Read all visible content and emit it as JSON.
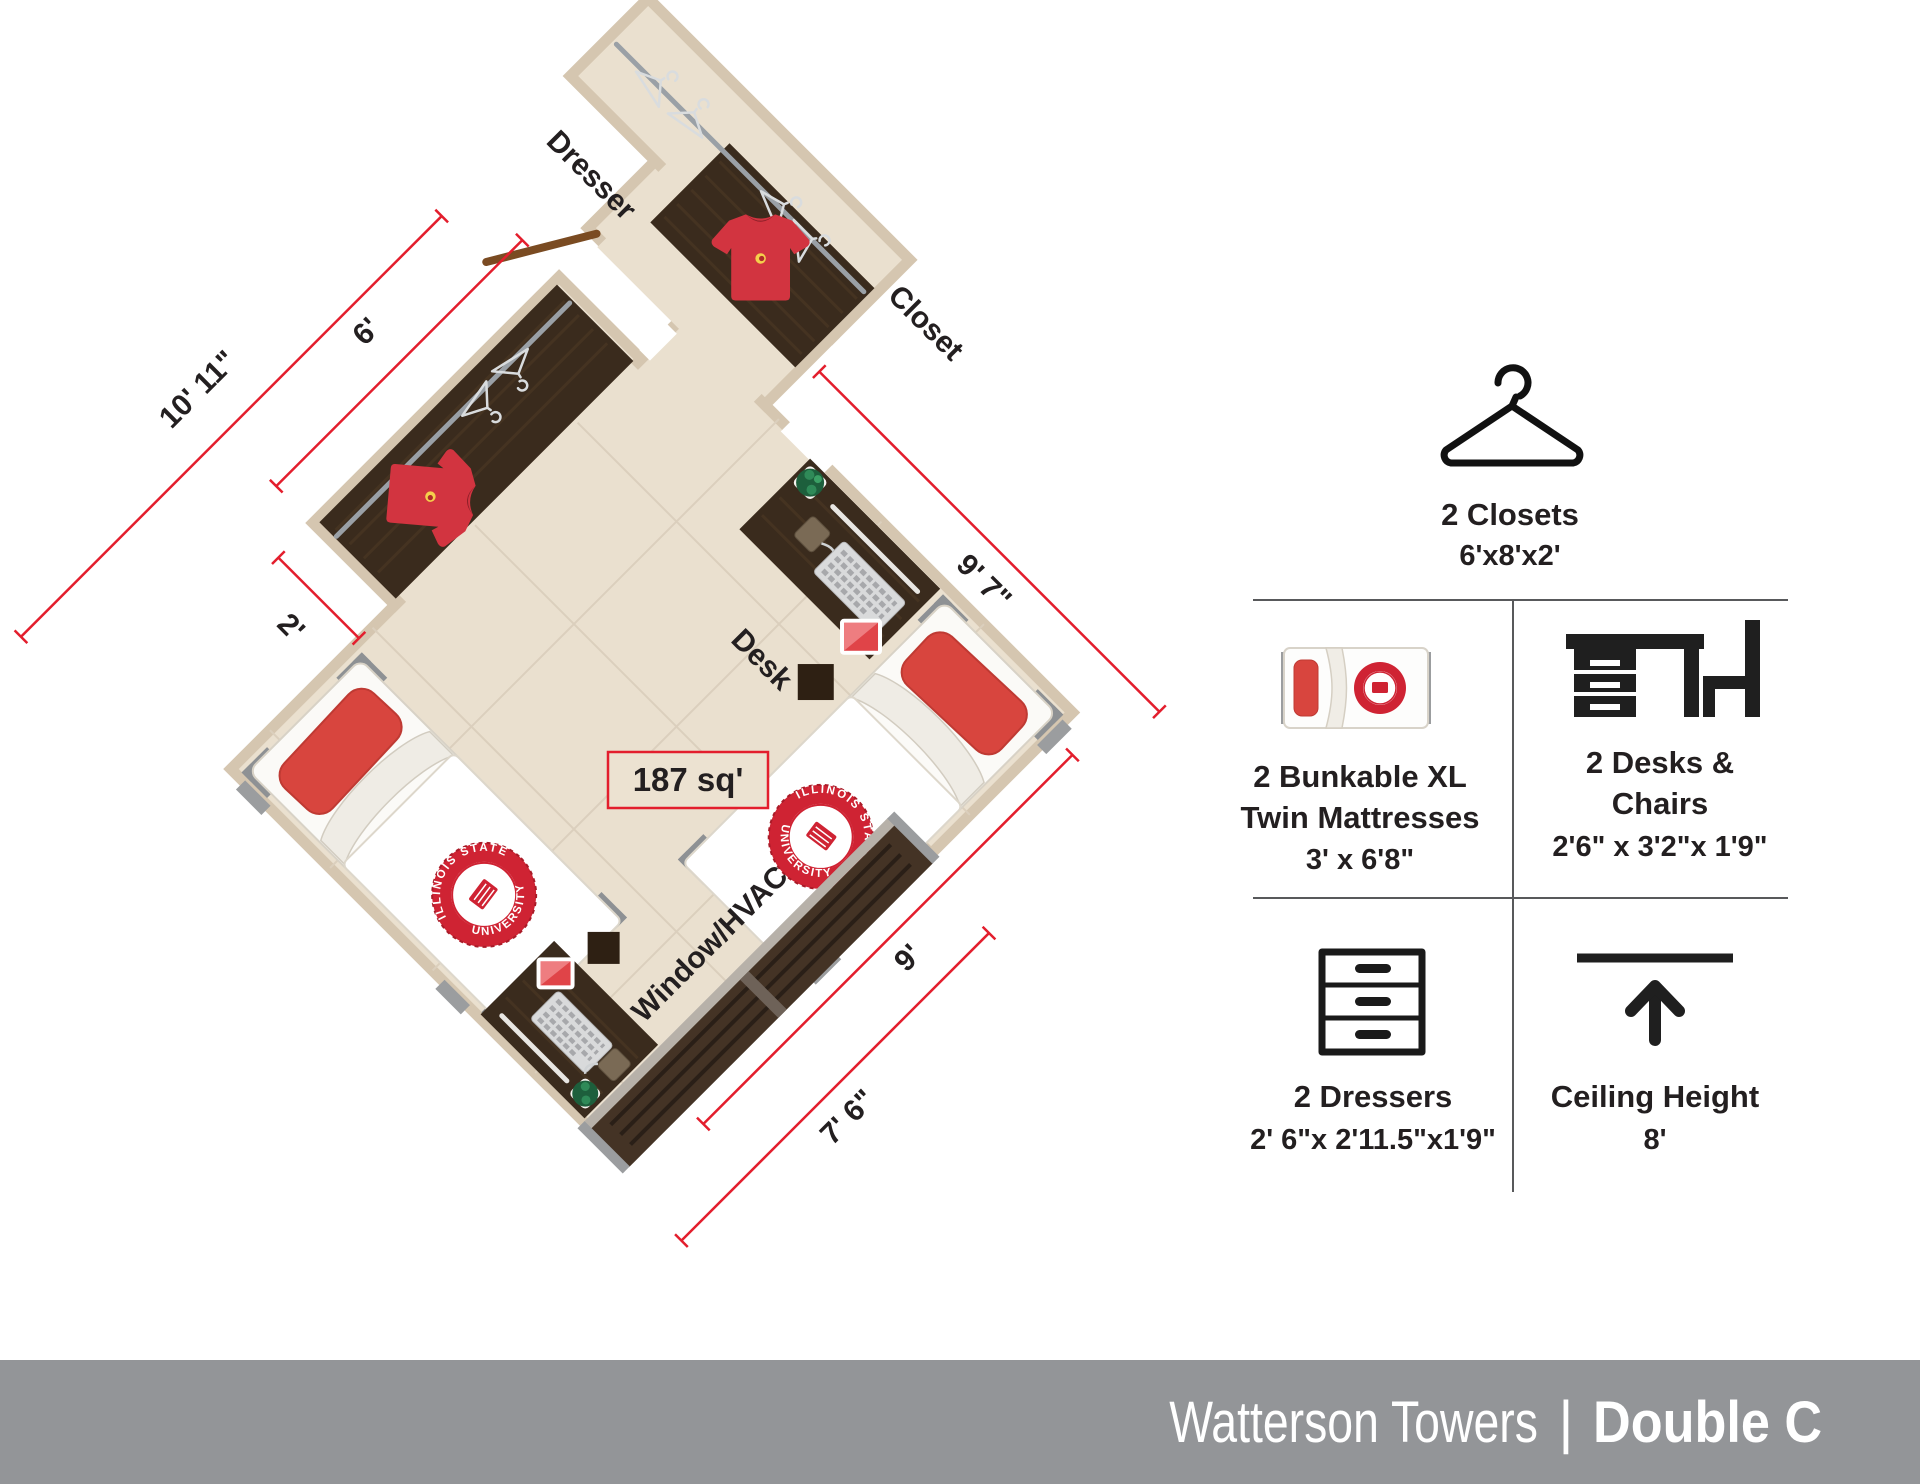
{
  "floor_plan": {
    "area_label": "187 sq'",
    "labels": {
      "closet": "Closet",
      "dresser": "Dresser",
      "desk": "Desk",
      "window": "Window/HVAC"
    },
    "dimensions": {
      "top_wall": "9' 7\"",
      "right_side": "9'",
      "window_wall": "7' 6\"",
      "left_wall": "10' 11\"",
      "closet_length": "6'",
      "closet_depth": "2'"
    },
    "seal": {
      "top_text": "ILLINOIS STATE",
      "bottom_text": "UNIVERSITY"
    },
    "colors": {
      "floor": "#eae0cf",
      "wall": "#d5c6b0",
      "wood": "#3a2b1d",
      "window": "#443325",
      "dimension_red": "#e31e2d",
      "bed_red": "#d8453e",
      "seal_red": "#cf2333",
      "jersey_red": "#d23440"
    }
  },
  "legend": {
    "closets": {
      "icon": "hanger-icon",
      "title": "2 Closets",
      "size": "6'x8'x2'"
    },
    "mattresses": {
      "icon": "mattress-icon",
      "line1": "2 Bunkable XL",
      "line2": "Twin Mattresses",
      "size": "3' x 6'8\""
    },
    "desks": {
      "icon": "desk-chair-icon",
      "line1": "2 Desks &",
      "line2": "Chairs",
      "size": "2'6\" x 3'2\"x 1'9\""
    },
    "dressers": {
      "icon": "dresser-icon",
      "title": "2 Dressers",
      "size": "2' 6\"x 2'11.5\"x1'9\""
    },
    "ceiling": {
      "icon": "ceiling-height-icon",
      "title": "Ceiling Height",
      "size": "8'"
    }
  },
  "footer": {
    "building": "Watterson Towers",
    "separator": "|",
    "unit": "Double C"
  }
}
